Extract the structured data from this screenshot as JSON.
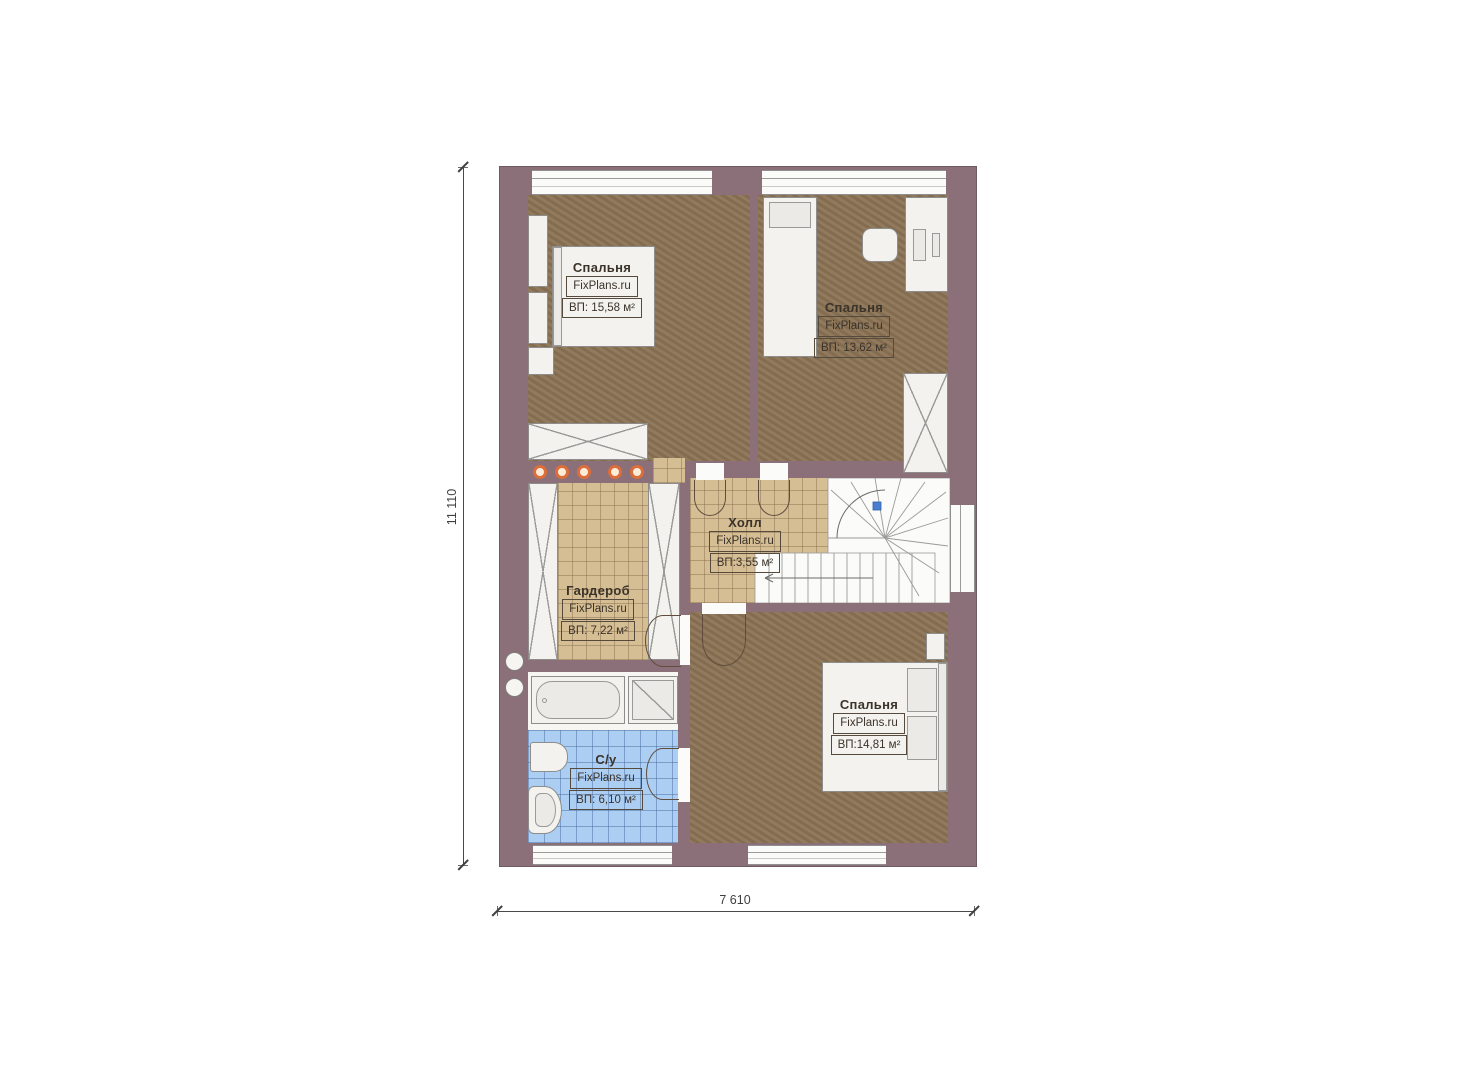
{
  "title": "Floor plan — second storey",
  "brand": "FixPlans.ru",
  "rooms": [
    {
      "key": "bedroom-top-left",
      "name": "Спальня",
      "brand": "FixPlans.ru",
      "area": "ВП: 15,58 м²"
    },
    {
      "key": "bedroom-top-right",
      "name": "Спальня",
      "brand": "FixPlans.ru",
      "area": "ВП: 13,62 м²"
    },
    {
      "key": "hall",
      "name": "Холл",
      "brand": "FixPlans.ru",
      "area": "ВП:3,55 м²"
    },
    {
      "key": "wardrobe",
      "name": "Гардероб",
      "brand": "FixPlans.ru",
      "area": "ВП: 7,22 м²"
    },
    {
      "key": "bathroom",
      "name": "С/у",
      "brand": "FixPlans.ru",
      "area": "ВП: 6,10 м²"
    },
    {
      "key": "bedroom-bottom",
      "name": "Спальня",
      "brand": "FixPlans.ru",
      "area": "ВП:14,81 м²"
    }
  ],
  "dimensions": {
    "height_mm": "11 110",
    "width_mm": "7 610"
  },
  "colors": {
    "wall": "#8b7079",
    "wood_floor": "#8b7354",
    "tile_floor": "#d5bd94",
    "bath_floor": "#accef3",
    "spotlight_accent": "#db6e3a",
    "stair_marker": "#4a7fd0"
  }
}
